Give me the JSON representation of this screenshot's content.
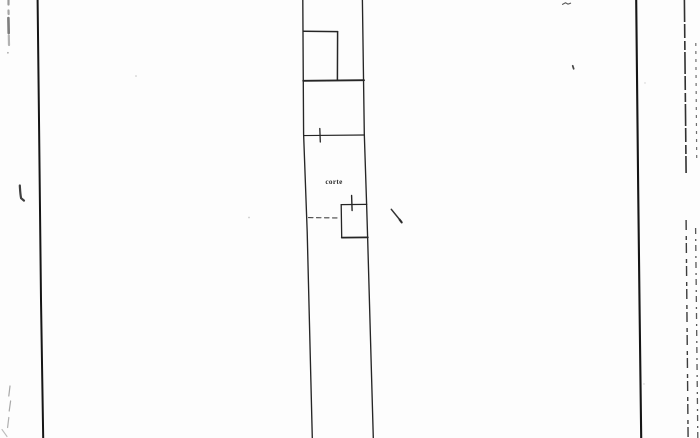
{
  "colors": {
    "paper": "#fdfdfd",
    "ink": "#262626",
    "ink_strong": "#161616",
    "artifact_dark": "#3d3d3d",
    "artifact_gray": "#8f8f8f",
    "artifact_faint": "#b5b5b5"
  },
  "plan": {
    "courtyard_label": "corte"
  }
}
